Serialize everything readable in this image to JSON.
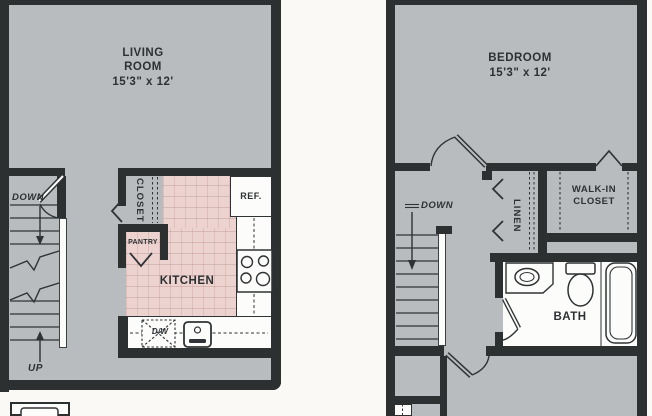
{
  "colors": {
    "wall": "#2c3031",
    "floor": "#b8bcbe",
    "kitchen_floor": "#ecd3cf",
    "fixture_white": "#fcfcfa",
    "background": "#faf9f5",
    "text": "#2d3133"
  },
  "left_unit": {
    "living_room_label": "LIVING\nROOM",
    "living_room_dims": "15'3\" x 12'",
    "closet_label": "CLOSET",
    "pantry_label": "PANTRY",
    "kitchen_label": "KITCHEN",
    "refrigerator_label": "REF.",
    "dishwasher_label": "D/W",
    "stairs_down_label": "DOWN",
    "stairs_up_label": "UP"
  },
  "right_unit": {
    "bedroom_label": "BEDROOM",
    "bedroom_dims": "15'3\" x 12'",
    "stairs_down_label": "DOWN",
    "linen_label": "LINEN",
    "walk_in_closet_label": "WALK-IN\nCLOSET",
    "bath_label": "BATH"
  }
}
